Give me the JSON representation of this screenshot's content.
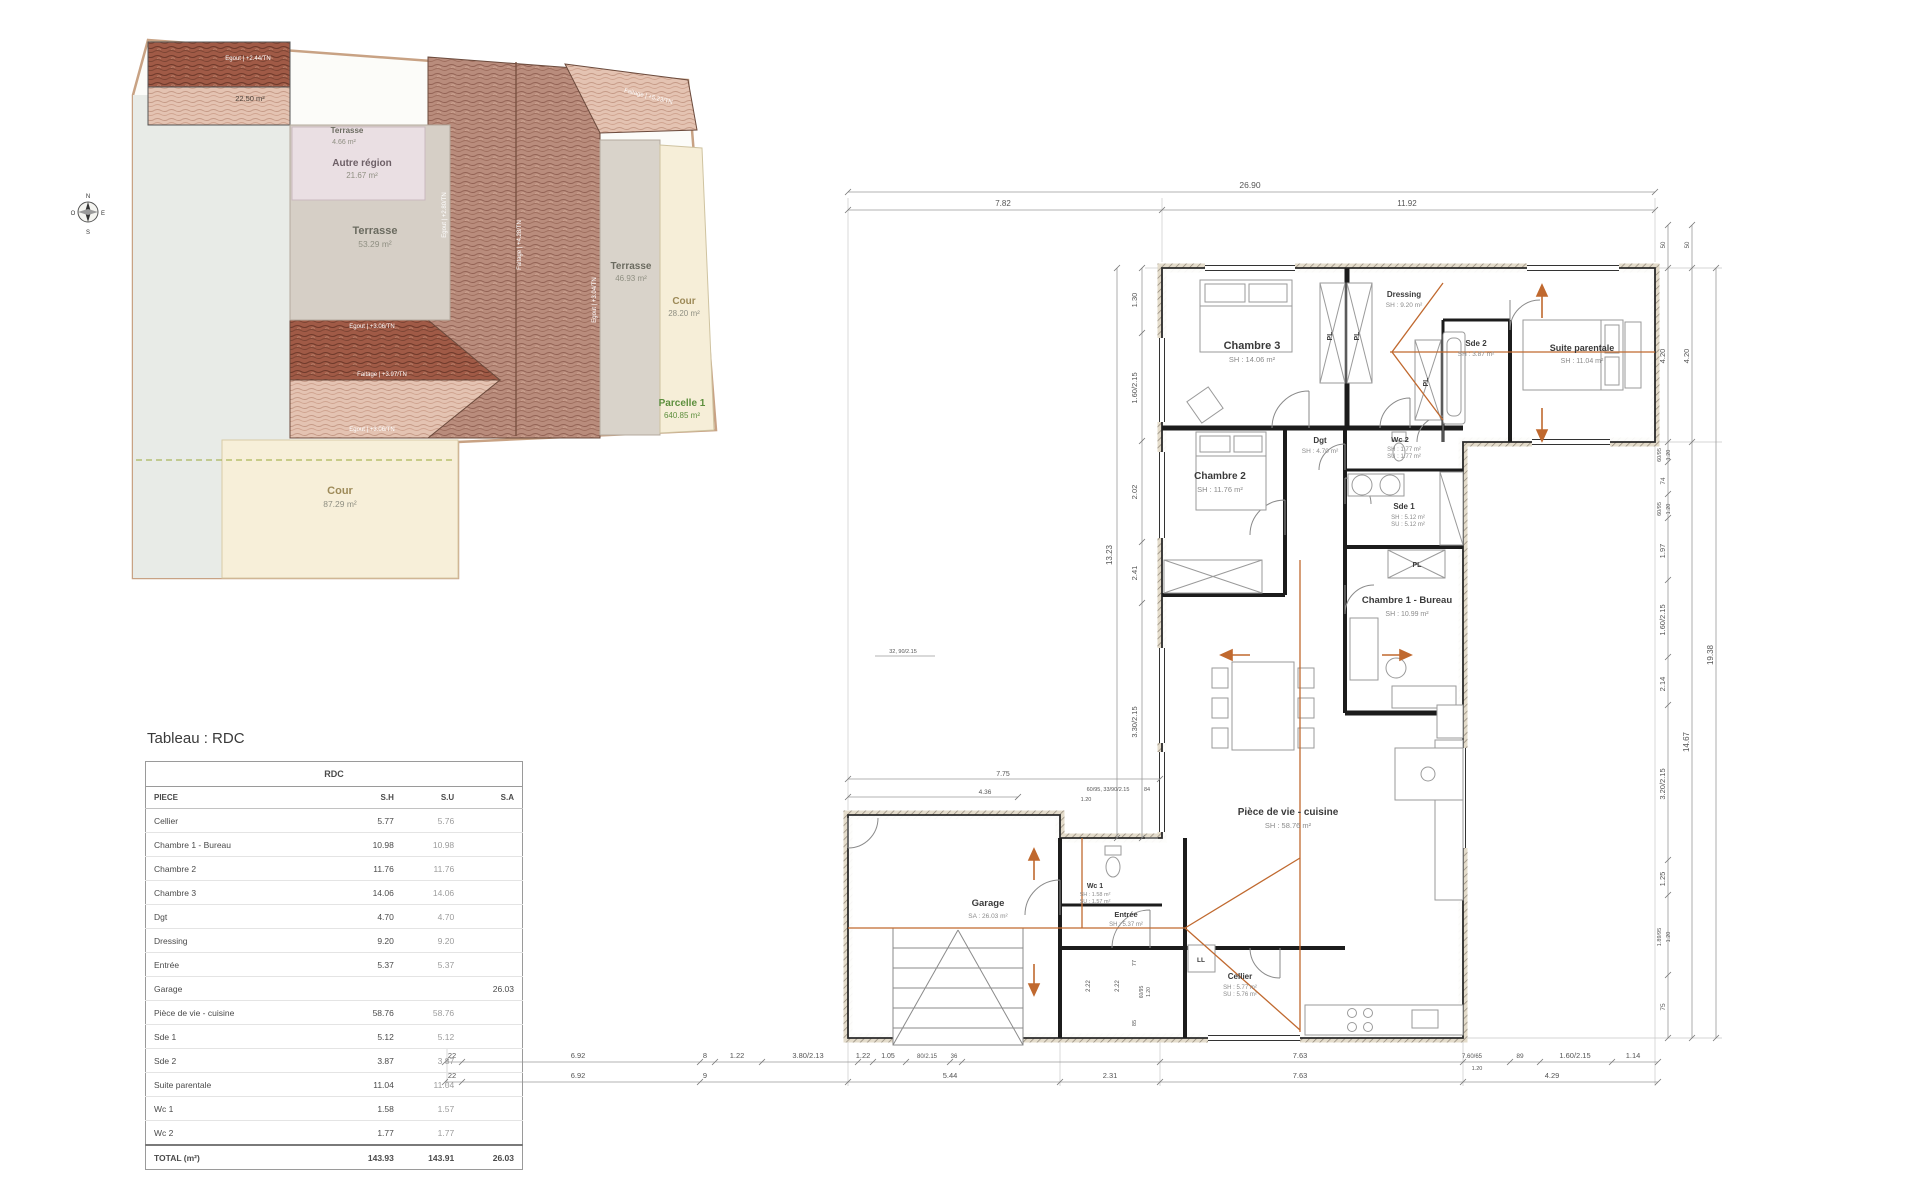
{
  "site_plan": {
    "areas": {
      "roof_small": {
        "area": "22.50 m²"
      },
      "terrasse_top": {
        "name": "Terrasse",
        "area": "4.66 m²"
      },
      "autre_region": {
        "name": "Autre région",
        "area": "21.67 m²"
      },
      "terrasse_main": {
        "name": "Terrasse",
        "area": "53.29 m²"
      },
      "terrasse_east": {
        "name": "Terrasse",
        "area": "46.93 m²"
      },
      "cour_east": {
        "name": "Cour",
        "area": "28.20 m²"
      },
      "parcelle": {
        "name": "Parcelle 1",
        "area": "640.85 m²"
      },
      "cour_south": {
        "name": "Cour",
        "area": "87.29 m²"
      }
    },
    "roof_labels": {
      "tl_egout": "Egout | +2.44/TN",
      "main_egout_l": "Egout | +2.80/TN",
      "main_faitage": "Faitage | +4.28/TN",
      "main_egout_r": "Egout | +3.04/TN",
      "tr_egout": "Egout | +4.04/TN",
      "tr_faitage": "Faitage | +5.23/TN",
      "gable_egout_t": "Egout | +3.06/TN",
      "gable_faitage": "Faitage | +3.97/TN",
      "gable_egout_b": "Egout | +3.06/TN"
    },
    "compass": {
      "n": "N",
      "s": "S",
      "e": "E",
      "o": "O"
    }
  },
  "table": {
    "title": "Tableau : RDC",
    "header": "RDC",
    "columns": {
      "piece": "PIECE",
      "sh": "S.H",
      "su": "S.U",
      "sa": "S.A"
    },
    "rows": [
      {
        "piece": "Cellier",
        "sh": "5.77",
        "su": "5.76",
        "sa": ""
      },
      {
        "piece": "Chambre 1 - Bureau",
        "sh": "10.98",
        "su": "10.98",
        "sa": ""
      },
      {
        "piece": "Chambre 2",
        "sh": "11.76",
        "su": "11.76",
        "sa": ""
      },
      {
        "piece": "Chambre 3",
        "sh": "14.06",
        "su": "14.06",
        "sa": ""
      },
      {
        "piece": "Dgt",
        "sh": "4.70",
        "su": "4.70",
        "sa": ""
      },
      {
        "piece": "Dressing",
        "sh": "9.20",
        "su": "9.20",
        "sa": ""
      },
      {
        "piece": "Entrée",
        "sh": "5.37",
        "su": "5.37",
        "sa": ""
      },
      {
        "piece": "Garage",
        "sh": "",
        "su": "",
        "sa": "26.03"
      },
      {
        "piece": "Pièce de vie - cuisine",
        "sh": "58.76",
        "su": "58.76",
        "sa": ""
      },
      {
        "piece": "Sde 1",
        "sh": "5.12",
        "su": "5.12",
        "sa": ""
      },
      {
        "piece": "Sde 2",
        "sh": "3.87",
        "su": "3.87",
        "sa": ""
      },
      {
        "piece": "Suite parentale",
        "sh": "11.04",
        "su": "11.04",
        "sa": ""
      },
      {
        "piece": "Wc 1",
        "sh": "1.58",
        "su": "1.57",
        "sa": ""
      },
      {
        "piece": "Wc 2",
        "sh": "1.77",
        "su": "1.77",
        "sa": ""
      }
    ],
    "total": {
      "piece": "TOTAL (m²)",
      "sh": "143.93",
      "su": "143.91",
      "sa": "26.03"
    }
  },
  "fp": {
    "rooms": {
      "chambre3": {
        "name": "Chambre 3",
        "a1": "SH : 14.06 m²"
      },
      "dressing": {
        "name": "Dressing",
        "a1": "SH : 9.20 m²"
      },
      "sde2": {
        "name": "Sde 2",
        "a1": "SH : 3.87 m²"
      },
      "suite": {
        "name": "Suite parentale",
        "a1": "SH : 11.04 m²"
      },
      "chambre2": {
        "name": "Chambre 2",
        "a1": "SH : 11.76 m²"
      },
      "dgt": {
        "name": "Dgt",
        "a1": "SH : 4.70 m²"
      },
      "wc2": {
        "name": "Wc 2",
        "a1": "SH : 1.77 m²",
        "a2": "SU : 1.77 m²"
      },
      "sde1": {
        "name": "Sde 1",
        "a1": "SH : 5.12 m²",
        "a2": "SU : 5.12 m²"
      },
      "chambre1": {
        "name": "Chambre 1 - Bureau",
        "a1": "SH : 10.99 m²"
      },
      "vie": {
        "name": "Pièce de vie - cuisine",
        "a1": "SH : 58.76 m²"
      },
      "wc1": {
        "name": "Wc 1",
        "a1": "SH : 1.58 m²",
        "a2": "SU : 1.57 m²"
      },
      "entree": {
        "name": "Entrée",
        "a1": "SH : 5.37 m²"
      },
      "garage": {
        "name": "Garage",
        "a1": "SA : 26.03 m²"
      },
      "cellier": {
        "name": "Cellier",
        "a1": "SH : 5.77 m²",
        "a2": "SU : 5.76 m²"
      }
    },
    "labels": {
      "pl": "PL",
      "ll": "LL"
    },
    "dims": {
      "top_total": "26.90",
      "top_a": "7.82",
      "top_b": "11.92",
      "left_total": "13.23",
      "l1": "1.30",
      "l2": "1.60/2.15",
      "l3": "2.02",
      "l4": "2.41",
      "l5": "3.30/2.15",
      "r1": "50",
      "r2": "50",
      "r3": "4.20",
      "r4": "4.20",
      "r5": "60/95",
      "r6": "1.20",
      "r7": "74",
      "r8": "60/95",
      "r9": "1.20",
      "r10": "1.97",
      "r11": "1.60/2.15",
      "r12": "2.14",
      "r13": "3.20/2.15",
      "r14": "1.25",
      "r15": "1.89/95",
      "r16": "1.20",
      "r17": "75",
      "r_sub": "14.67",
      "r_total": "19.38",
      "b1a": "22",
      "b1b": "6.92",
      "b1c": "8",
      "b1d": "1.22",
      "b1e": "3.80/2.13",
      "b1f": "1.22",
      "b1g": "1.05",
      "b1h": "80/2.15",
      "b1i": "36",
      "b1j": "7.63",
      "b1k": "7.60/65",
      "b1l": "1.20",
      "b1m": "89",
      "b1n": "1.60/2.15",
      "b1o": "1.14",
      "b2a": "22",
      "b2b": "6.92",
      "b2c": "9",
      "b2d": "5.44",
      "b2e": "2.31",
      "b2f": "7.63",
      "b2g": "4.29",
      "m1": "7.75",
      "m2": "4.36",
      "m3": "60/95, 33/90/2.15",
      "m4": "84",
      "m5": "1.20",
      "m6": "32, 90/2.15",
      "m7": "2.22",
      "m8": "2.22",
      "m9": "77",
      "m10": "60/95",
      "m11": "1.20",
      "m12": "85"
    }
  }
}
